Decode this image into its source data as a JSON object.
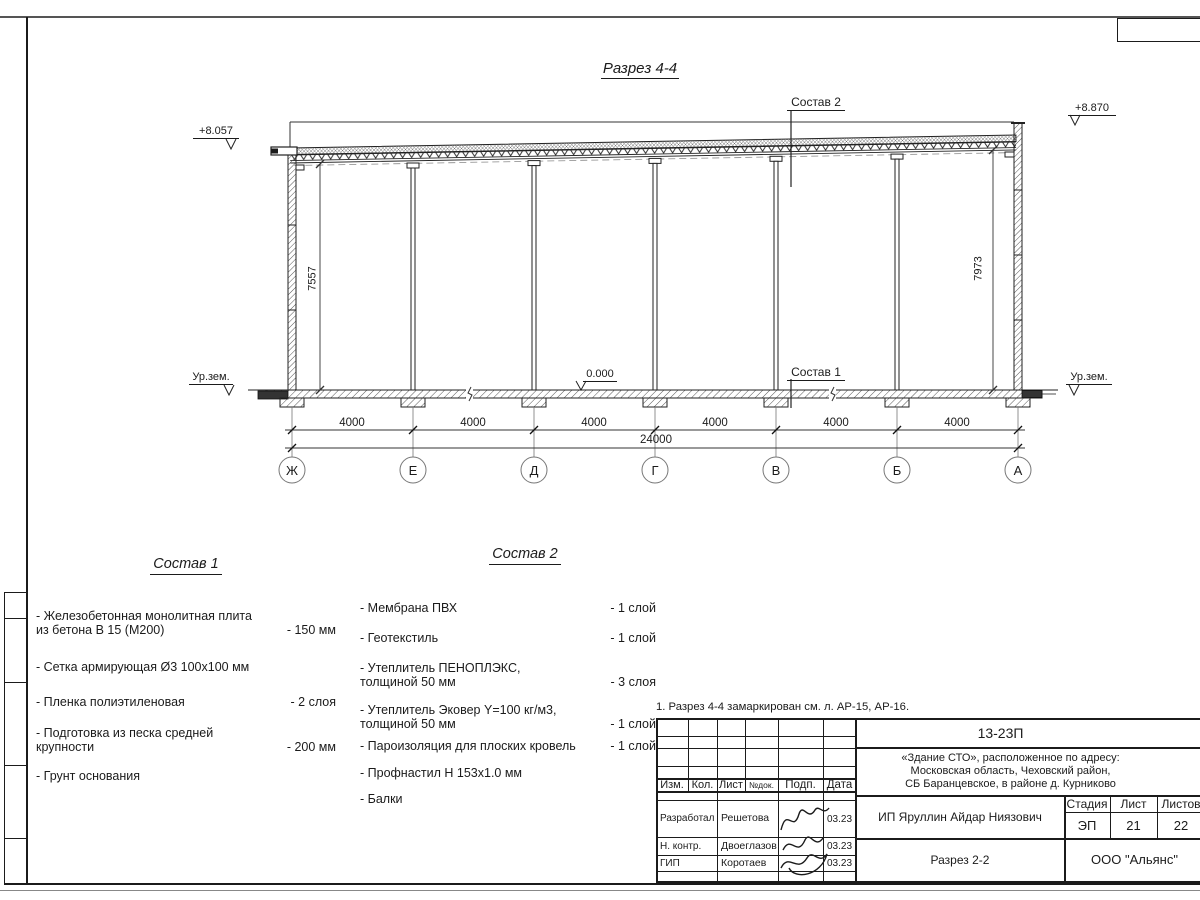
{
  "drawing": {
    "title": "Разрез 4-4",
    "elevations": {
      "top_left": "+8.057",
      "top_right": "+8.870",
      "zero": "0.000",
      "ground_left": "Ур.зем.",
      "ground_right": "Ур.зем."
    },
    "leader_labels": {
      "sostav1": "Состав 1",
      "sostav2": "Состав 2"
    },
    "dimensions": {
      "height_left": "7557",
      "height_right": "7973",
      "bays": [
        "4000",
        "4000",
        "4000",
        "4000",
        "4000",
        "4000"
      ],
      "total": "24000"
    },
    "axes": [
      "Ж",
      "Е",
      "Д",
      "Г",
      "В",
      "Б",
      "А"
    ]
  },
  "sostav1": {
    "heading": "Состав 1",
    "items": [
      {
        "name": "- Железобетонная  монолитная плита\nиз бетона В 15 (М200)",
        "qty": "- 150 мм"
      },
      {
        "name": "- Сетка армирующая Ø3 100х100 мм",
        "qty": ""
      },
      {
        "name": "- Пленка полиэтиленовая",
        "qty": "-  2 слоя"
      },
      {
        "name": "- Подготовка из песка средней\nкрупности",
        "qty": "- 200 мм"
      },
      {
        "name": "- Грунт основания",
        "qty": ""
      }
    ]
  },
  "sostav2": {
    "heading": "Состав 2",
    "items": [
      {
        "name": "- Мембрана ПВХ",
        "qty": "- 1 слой"
      },
      {
        "name": "- Геотекстиль",
        "qty": "- 1 слой"
      },
      {
        "name": "- Утеплитель ПЕНОПЛЭКС,\nтолщиной 50 мм",
        "qty": "- 3 слоя"
      },
      {
        "name": "- Утеплитель Эковер Y=100 кг/м3,\nтолщиной 50 мм",
        "qty": "- 1 слой"
      },
      {
        "name": "- Пароизоляция для плоских кровель",
        "qty": "- 1 слой"
      },
      {
        "name": "- Профнастил Н 153х1.0 мм",
        "qty": ""
      },
      {
        "name": "- Балки",
        "qty": ""
      }
    ]
  },
  "note": "1. Разрез 4-4 замаркирован см. л. АР-15, АР-16.",
  "title_block": {
    "doc_number": "13-23П",
    "address_line1": "«Здание СТО», расположенное по адресу:",
    "address_line2": "Московская область, Чеховский район,",
    "address_line3": "СБ Баранцевское, в районе д. Курниково",
    "header": {
      "izm": "Изм.",
      "kol": "Кол.",
      "list": "Лист",
      "ndok": "№док.",
      "podp": "Подп.",
      "data": "Дата"
    },
    "rows": [
      {
        "role": "Разработал",
        "name": "Решетова",
        "date": "03.23"
      },
      {
        "role": "Н. контр.",
        "name": "Двоеглазов",
        "date": "03.23"
      },
      {
        "role": "ГИП",
        "name": "Коротаев",
        "date": "03.23"
      }
    ],
    "client": "ИП Яруллин Айдар Ниязович",
    "stage_label": "Стадия",
    "sheet_label": "Лист",
    "sheets_label": "Листов",
    "stage": "ЭП",
    "sheet": "21",
    "sheets": "22",
    "section_name": "Разрез 2-2",
    "company": "ООО \"Альянс\""
  }
}
